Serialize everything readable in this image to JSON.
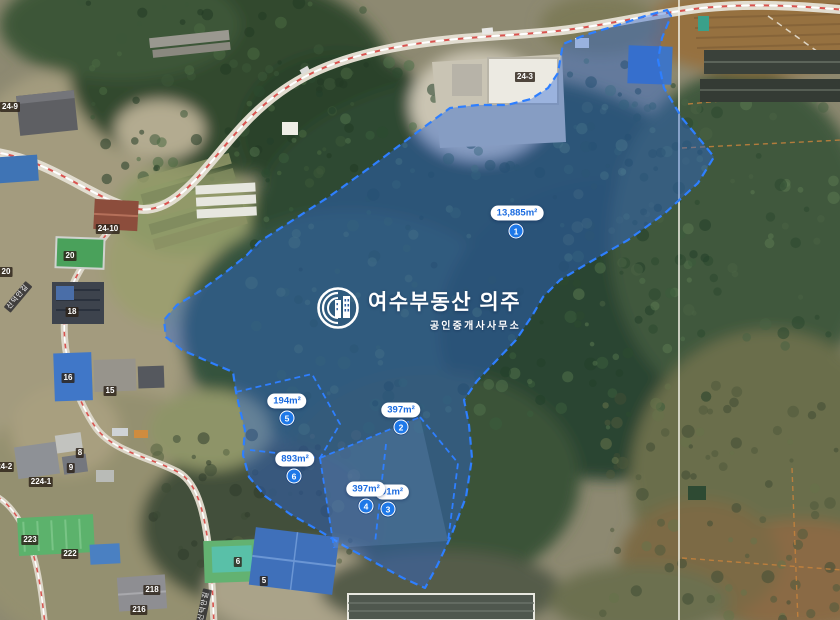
{
  "watermark": {
    "title": "여수부동산 의주",
    "subtitle": "공인중개사사무소"
  },
  "colors": {
    "overlay_fill": "#2a66d8",
    "overlay_stroke": "#2e7fff",
    "pill_text": "#1a6be0",
    "badge_bg": "#1e78e8"
  },
  "parcels": [
    {
      "no": "1",
      "area": "13,885m²",
      "pill": {
        "x": 517,
        "y": 213
      },
      "badge": {
        "x": 516,
        "y": 231
      }
    },
    {
      "no": "2",
      "area": "397m²",
      "pill": {
        "x": 401,
        "y": 410
      },
      "badge": {
        "x": 401,
        "y": 427
      }
    },
    {
      "no": "3",
      "area": "91m²",
      "pill": {
        "x": 392,
        "y": 492
      },
      "badge": {
        "x": 388,
        "y": 509
      }
    },
    {
      "no": "4",
      "area": "397m²",
      "pill": {
        "x": 366,
        "y": 489
      },
      "badge": {
        "x": 366,
        "y": 506
      }
    },
    {
      "no": "5",
      "area": "194m²",
      "pill": {
        "x": 287,
        "y": 401
      },
      "badge": {
        "x": 287,
        "y": 418
      }
    },
    {
      "no": "6",
      "area": "893m²",
      "pill": {
        "x": 295,
        "y": 459
      },
      "badge": {
        "x": 294,
        "y": 476
      }
    }
  ],
  "lot_labels": [
    {
      "text": "24-9",
      "x": 10,
      "y": 107
    },
    {
      "text": "24-10",
      "x": 108,
      "y": 229
    },
    {
      "text": "20",
      "x": 70,
      "y": 256
    },
    {
      "text": "20",
      "x": 6,
      "y": 272
    },
    {
      "text": "18",
      "x": 72,
      "y": 312
    },
    {
      "text": "16",
      "x": 68,
      "y": 378
    },
    {
      "text": "15",
      "x": 110,
      "y": 391
    },
    {
      "text": "8",
      "x": 80,
      "y": 453
    },
    {
      "text": "9",
      "x": 71,
      "y": 468
    },
    {
      "text": "224-2",
      "x": 2,
      "y": 467
    },
    {
      "text": "224-1",
      "x": 41,
      "y": 482
    },
    {
      "text": "223",
      "x": 30,
      "y": 540
    },
    {
      "text": "222",
      "x": 70,
      "y": 554
    },
    {
      "text": "218",
      "x": 152,
      "y": 590
    },
    {
      "text": "216",
      "x": 139,
      "y": 610
    },
    {
      "text": "24-3",
      "x": 525,
      "y": 77
    },
    {
      "text": "6",
      "x": 238,
      "y": 562
    },
    {
      "text": "5",
      "x": 264,
      "y": 581
    }
  ],
  "road_labels": [
    {
      "text": "신덕안길",
      "x": 18,
      "y": 297,
      "rot": -50
    },
    {
      "text": "신덕안길",
      "x": 204,
      "y": 606,
      "rot": -78
    }
  ]
}
